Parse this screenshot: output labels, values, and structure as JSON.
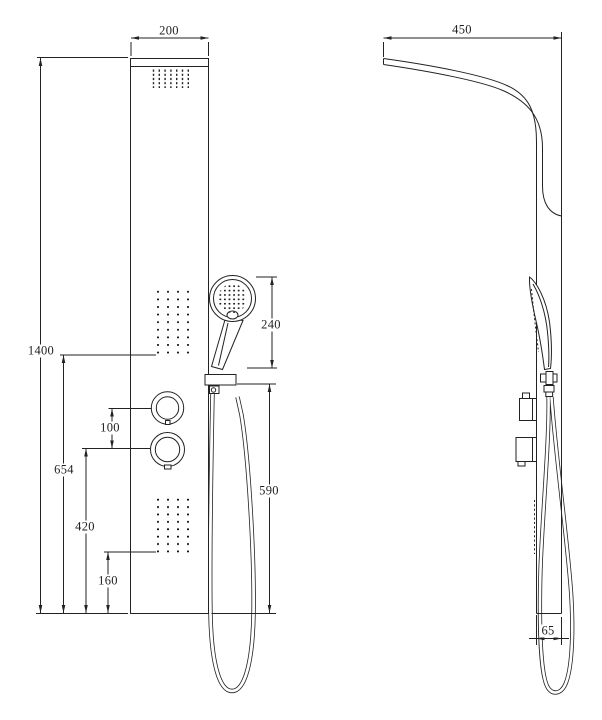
{
  "drawing": {
    "kind": "shower-panel technical dimension drawing",
    "background_color": "#ffffff",
    "line_color": "#222222",
    "views": {
      "front": "front-view",
      "side": "side-view"
    },
    "dimensions": {
      "front_panel_width": "200",
      "front_panel_height": "1400",
      "upper_jets_from_bottom": "654",
      "lower_knob_from_bottom": "420",
      "lower_jets_from_bottom": "160",
      "knob_spacing": "100",
      "hand_shower_length": "240",
      "holder_to_bottom": "590",
      "side_top_depth": "450",
      "panel_thickness": "65"
    }
  }
}
